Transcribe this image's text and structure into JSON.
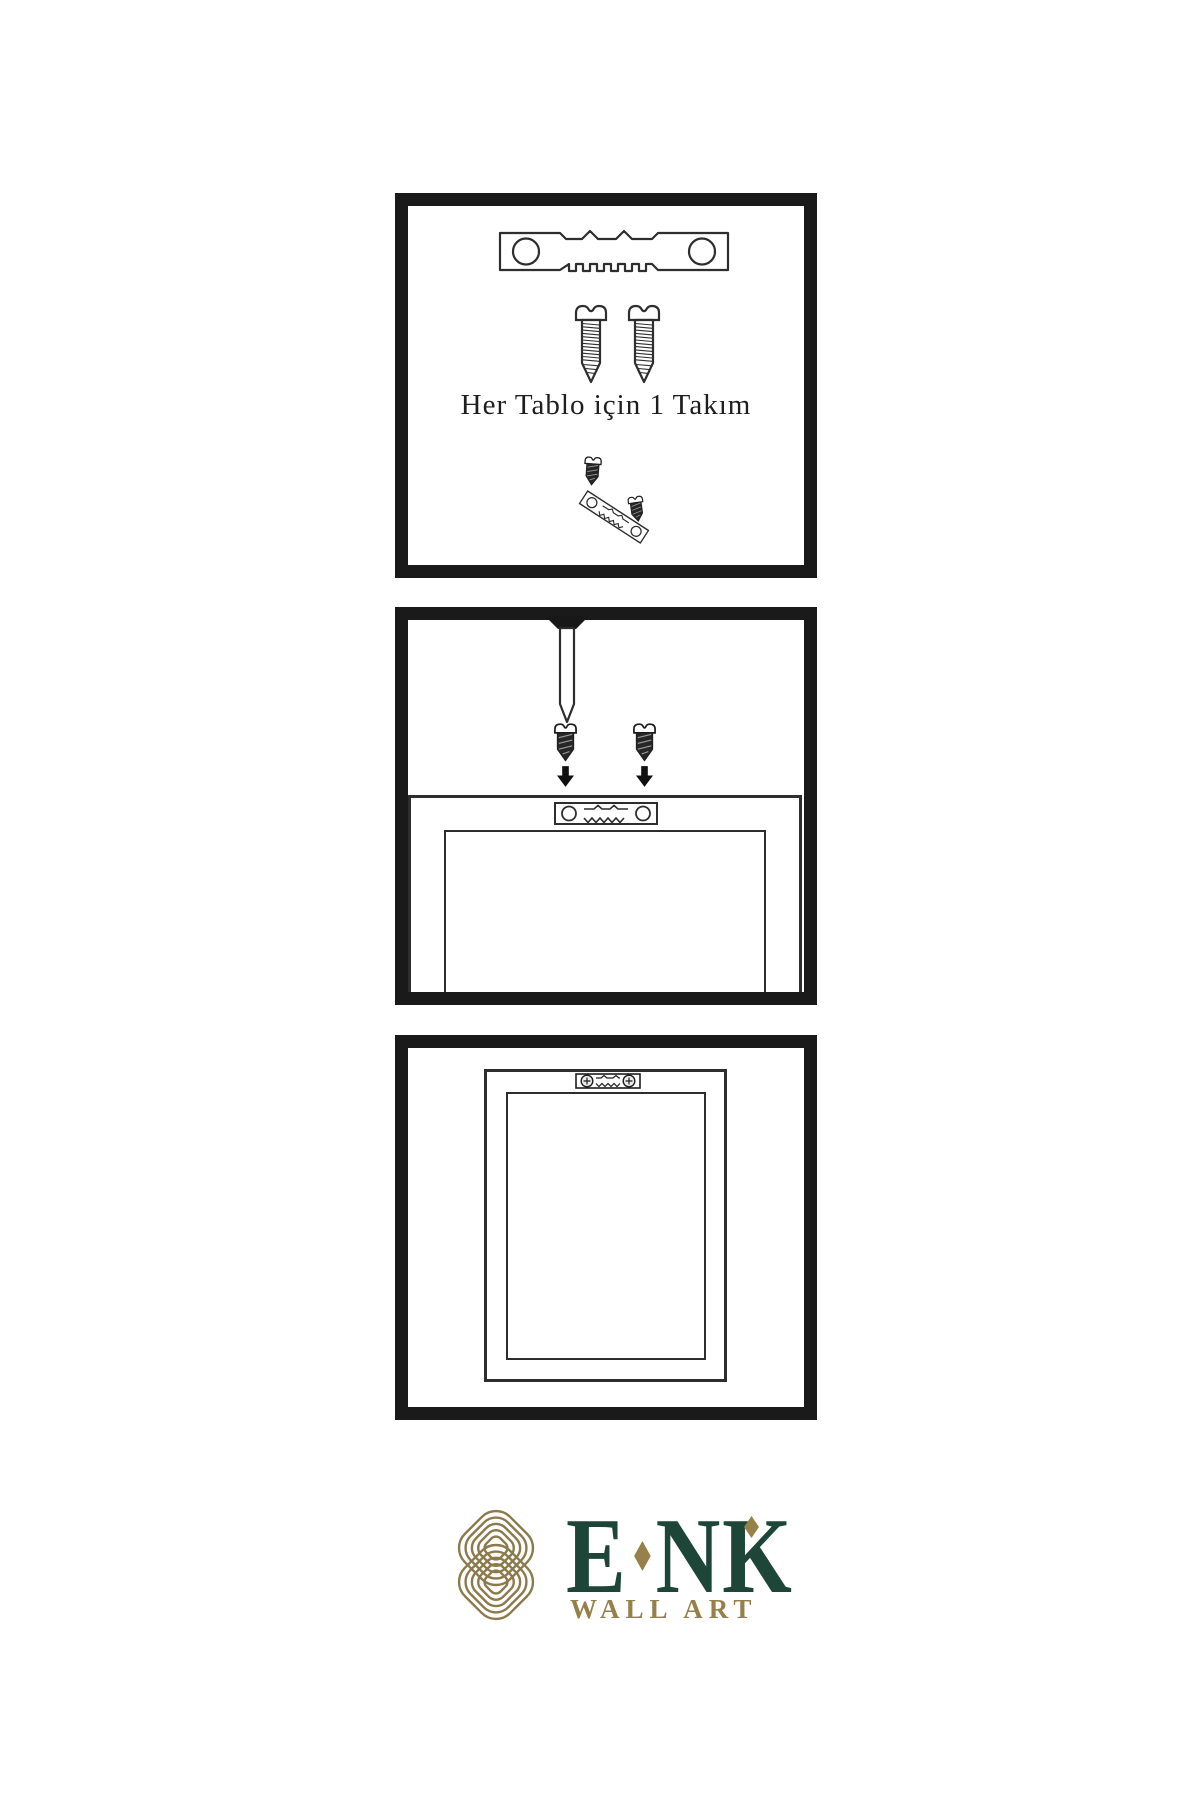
{
  "panel_kit": {
    "caption": "Her Tablo için 1 Takım"
  },
  "logo": {
    "parts": [
      "E",
      "NK"
    ],
    "tagline": "WALL ART",
    "brand_full": "ENK",
    "green": "#1d4639",
    "gold": "#97814a"
  },
  "colors": {
    "background": "#ffffff",
    "panel_border": "#1a1a1a",
    "line_art": "#2e2e2e",
    "screw_dark": "#262626"
  },
  "icons": {
    "sawtooth_hanger": "sawtooth-hanger-icon",
    "screw_light": "screw-icon",
    "screw_dark": "dark-screw-icon",
    "nail": "nail-icon",
    "down_arrow": "down-arrow-icon",
    "picture_frame": "picture-frame",
    "mounted_hanger": "mounted-hanger-icon",
    "brand_knot": "enk-knot-logo-icon"
  }
}
